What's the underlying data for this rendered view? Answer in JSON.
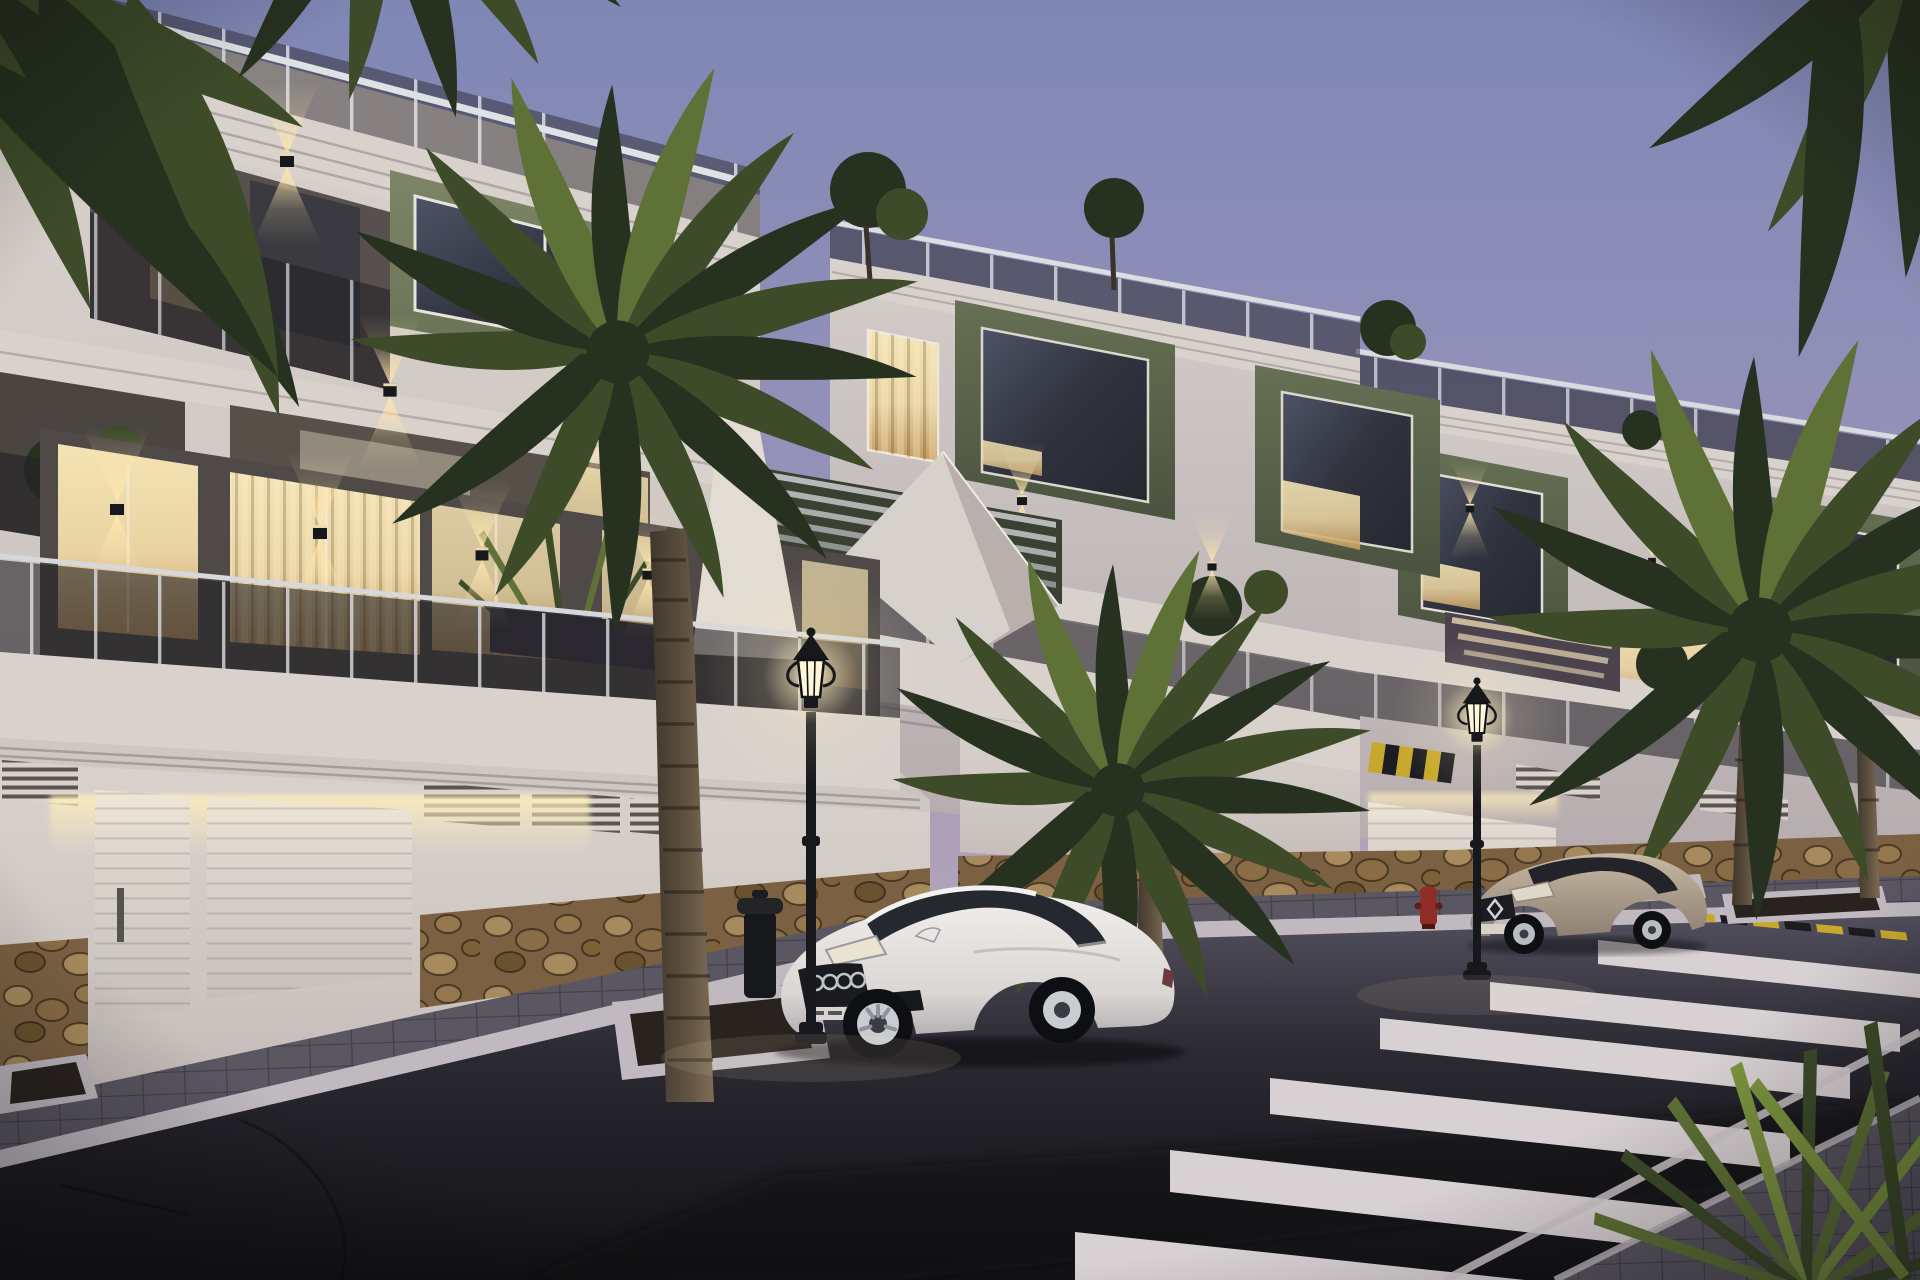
{
  "meta": {
    "scene": "residential-street-at-dusk",
    "ambience": "twilight",
    "visible_text": "none"
  },
  "palette": {
    "sky_top": "#7f87b5",
    "sky_mid": "#9a94ba",
    "sky_horizon": "#c1aeb9",
    "rose_glow": "#d6b0aa",
    "facade_light": "#d9d2cc",
    "facade_mid": "#c2b9b6",
    "facade_dark": "#958c95",
    "facade_warm": "#e9dbc0",
    "green_light": "#7d8566",
    "green_mid": "#667053",
    "green_dark": "#4b5340",
    "glass_smoke": "#232126",
    "glass_dark": "#30333e",
    "glass_sky": "#4d5366",
    "window_warm": "#e9d3a2",
    "window_amber": "#c29a5e",
    "glow": "#fff3cd",
    "stone_light": "#a78a5d",
    "stone_mid": "#7b6142",
    "stone_dark": "#463420",
    "asphalt_far": "#524f5d",
    "asphalt_mid": "#2b2931",
    "asphalt_near": "#121115",
    "paver": "#5a5662",
    "curb": "#c0bac0",
    "stripe": "#d8d1d3",
    "metal_dark": "#17181c",
    "trunk_light": "#7e6d55",
    "trunk_dark": "#3f372b",
    "palm_dark": "#27311f",
    "palm_mid": "#3d4b29",
    "palm_light": "#5e7136",
    "car_white_hi": "#f1eeeb",
    "car_white_lo": "#b4afb1",
    "car_beige_hi": "#c8b8a5",
    "car_beige_lo": "#8e8172",
    "hydrant_red": "#8f2c26",
    "marking_yellow": "#c7a82c",
    "soil": "#292320",
    "night_shadow": "#0b0a0e"
  },
  "scene": {
    "sky": {
      "condition": "clear-twilight-gradient"
    },
    "buildings": [
      {
        "id": "left-block",
        "walls": "white-render",
        "accent": "olive-green-volume",
        "floors_visible": 3,
        "railings": "smoked-glass",
        "roof": "glass-parapet-terrace",
        "lighting": [
          "up-down-wall-sconces",
          "warm-interior-windows",
          "garage-led-cove"
        ]
      },
      {
        "id": "center-block",
        "walls": "white-render",
        "accent": "olive-green-volumes",
        "floors_visible": 3,
        "railings": "smoked-glass",
        "roof": "terrace-with-shrubs"
      },
      {
        "id": "right-block",
        "walls": "white-render",
        "accent": "olive-green-volumes",
        "floors_visible": 3,
        "railings": "smoked-glass",
        "roof": "terrace-with-shrubs",
        "extra": "lit-exterior-stair"
      }
    ],
    "garage_level": {
      "doors": [
        "pedestrian-door",
        "wide-sectional-door",
        "lit-sectional-door-right"
      ],
      "vents": "louvre-grilles",
      "base": "natural-stone-wainscot"
    },
    "street": {
      "surface": "asphalt",
      "crosswalk_stripes": 6,
      "edge_line": true,
      "curb_marking": "yellow-black-dashes",
      "ramp_marking": "yellow-black-diagonals",
      "lamps": 2,
      "lamp_style": "classic-lantern-lit"
    },
    "vehicles": [
      {
        "id": "white-coupe",
        "body_color": "white",
        "state": "parked",
        "position": "foreground-center"
      },
      {
        "id": "beige-coupe",
        "body_color": "beige",
        "state": "parked",
        "position": "mid-right"
      }
    ],
    "vegetation": {
      "palm_trees": 4,
      "corner_frond_clusters": 3,
      "rooftop_shrubs": 5,
      "balcony_plants": true,
      "foreground_yucca": true
    },
    "street_furniture": [
      "litter-bin",
      "fire-hydrant",
      "tree-planters"
    ]
  }
}
